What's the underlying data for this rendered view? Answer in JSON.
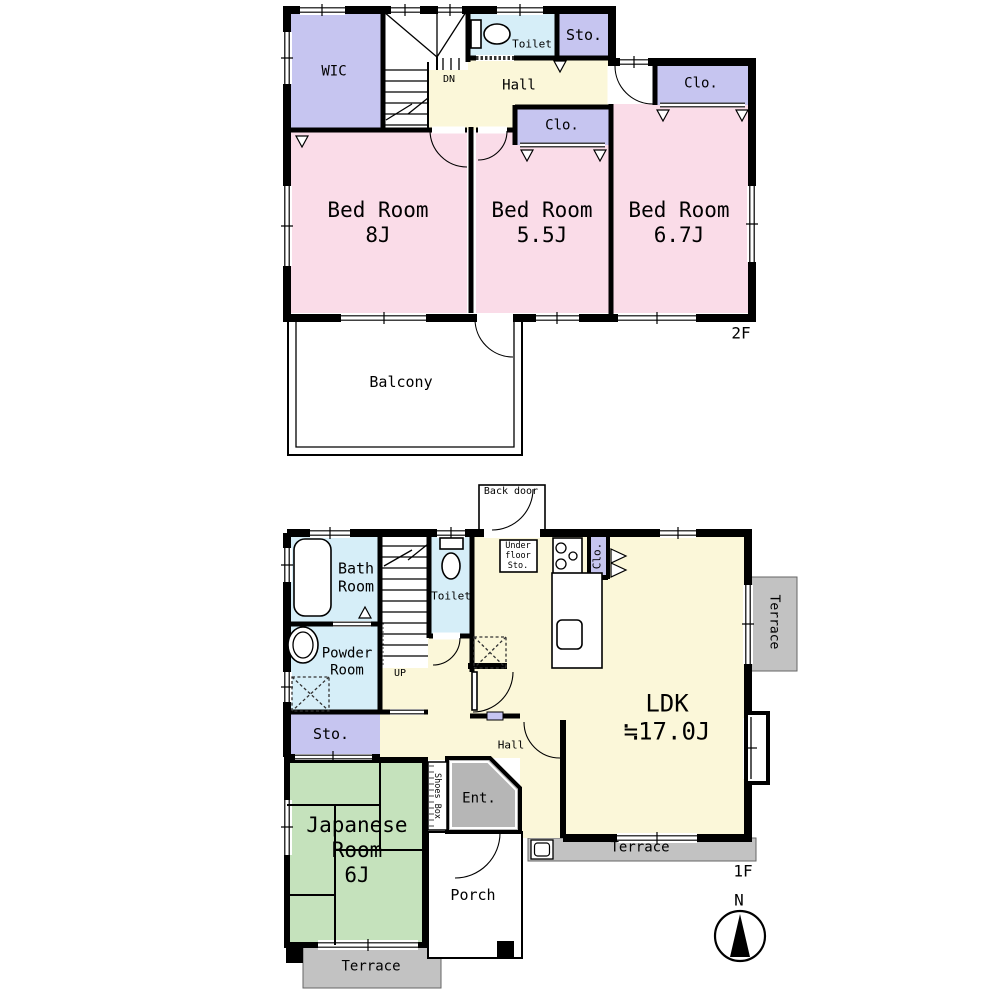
{
  "floor2": {
    "floor_label": "2F",
    "wic": "WIC",
    "toilet": "Toilet",
    "sto": "Sto.",
    "hall": "Hall",
    "dn": "DN",
    "clo_hall": "Clo.",
    "clo_bed2": "Clo.",
    "bed1": "Bed Room\n8J",
    "bed2": "Bed Room\n5.5J",
    "bed3": "Bed Room\n6.7J",
    "balcony": "Balcony"
  },
  "floor1": {
    "floor_label": "1F",
    "back_door": "Back door",
    "bath": "Bath\nRoom",
    "toilet": "Toilet",
    "under_floor_sto": "Under\nfloor\nSto.",
    "clo": "Clo.",
    "powder": "Powder\nRoom",
    "up": "UP",
    "sto": "Sto.",
    "hall": "Hall",
    "ldk": "LDK\n≒17.0J",
    "japanese": "Japanese\nRoom\n6J",
    "shoes_box": "Shoes Box",
    "ent": "Ent.",
    "porch": "Porch",
    "terrace_east": "Terrace",
    "terrace_south": "Terrace",
    "terrace_west": "Terrace"
  },
  "compass": {
    "north": "N"
  },
  "colors": {
    "room_pink": "#fadce8",
    "room_lavender": "#c6c5f0",
    "room_yellow": "#fbf7d9",
    "room_blue": "#d6eef8",
    "room_green": "#c5e2bc",
    "terrace_gray": "#c2c2c2",
    "entrance_gray": "#b6b6b6",
    "wall": "#000000"
  }
}
